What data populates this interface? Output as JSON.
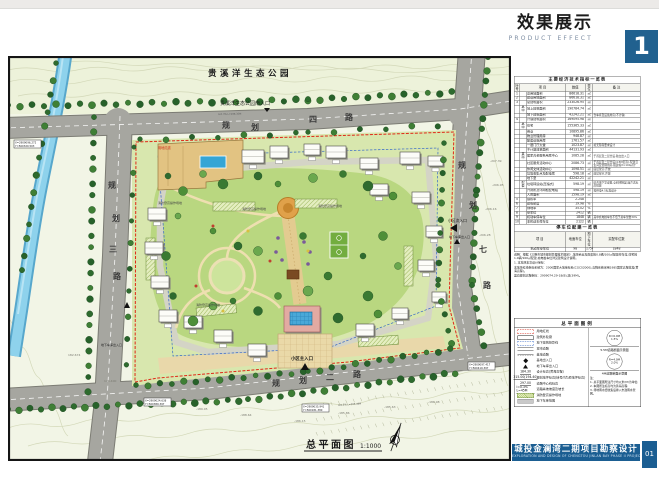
{
  "header": {
    "title_cn": "效果展示",
    "title_en": "PRODUCT  EFFECT",
    "page_num": "1"
  },
  "plan": {
    "park_label": "贵溪洋生态公园",
    "park_entrance_label": "贵溪洋生态公园南入口",
    "roads": {
      "top": "规划四路",
      "left": "规划三路",
      "right": "规划七路",
      "bottom": "规划二路"
    },
    "entrances": {
      "main": "小区主入口",
      "secondary": "小区次入口",
      "garage": "地下车库出入口"
    },
    "boundary_label": "用地红线",
    "fire_lane_label": "消防登高操作场地",
    "scale_label": "总平面图",
    "scale_value": "1:1000",
    "road_notes": [
      "i=0.5% L=205.49M",
      "i=0.3% L=198.35M"
    ],
    "spot_elevations": [
      "-207.39",
      "-206.95",
      "-206.16",
      "-206.28",
      "-189.05",
      "-188.64",
      "-186.15",
      "-185.86",
      "-185.63",
      "-186.98",
      "182.674",
      "176.400"
    ],
    "coord_markers": [
      {
        "x_val": "X=2909096.272",
        "y_val": "Y=560320.503"
      },
      {
        "x_val": "X=2909024.638",
        "y_val": "Y=560389.397"
      },
      {
        "x_val": "X=2909035.941",
        "y_val": "Y=560181.380"
      },
      {
        "x_val": "X=2909097.417",
        "y_val": "Y=560419.397"
      }
    ]
  },
  "table": {
    "title": "主要经济技术指标一览表",
    "headers": [
      "序号",
      "项  目",
      "数值",
      "单位",
      "备  注"
    ],
    "rows": [
      [
        "1",
        "",
        "总用地面积",
        "86618.31",
        "㎡",
        ""
      ],
      [
        "2",
        "",
        "建设用地面积",
        "86618.31",
        "㎡",
        ""
      ],
      [
        "3",
        "",
        "总建筑面积",
        "233026.95",
        "㎡",
        ""
      ],
      [
        "",
        "其中",
        "地上建筑面积",
        "190784.74",
        "㎡",
        ""
      ],
      [
        "",
        "",
        "地下建筑面积",
        "42242.21",
        "㎡",
        "含车库及设备用房(不计容)"
      ],
      [
        "4",
        "",
        "计容建筑面积",
        "169095.98",
        "㎡",
        ""
      ],
      [
        "",
        "其中",
        "住宅",
        "155365.33",
        "㎡",
        ""
      ],
      [
        "",
        "",
        "商业",
        "10895.86",
        "㎡",
        ""
      ],
      [
        "",
        "",
        "物业管理用房",
        "948.87",
        "㎡",
        ""
      ],
      [
        "",
        "",
        "配套设施用房",
        "1761.57",
        "㎡",
        ""
      ],
      [
        "",
        "",
        "一层门厅大堂",
        "1023.87",
        "㎡",
        "按无障碍要求设计"
      ],
      [
        "",
        "",
        "不计容建筑面积",
        "44131.93",
        "㎡",
        ""
      ],
      [
        "",
        "其中",
        "居家养老服务用房中心",
        "1085.28",
        "㎡",
        "于首层及二层合设,独立出入口"
      ],
      [
        "",
        "",
        "社区服务活动中心",
        "2086.73",
        "㎡",
        "于首层及二层合设(4.5M层高),配建卫生间及管理用房,报建按2×100㎡计"
      ],
      [
        "",
        "",
        "休闲文体活动中心",
        "1098.51",
        "㎡",
        "底层架空,开放"
      ],
      [
        "",
        "",
        "垃圾收集点及配电房",
        "598.18",
        "㎡",
        "底层架空,开放"
      ],
      [
        "",
        "",
        "地下室",
        "42242.21",
        "㎡",
        ""
      ],
      [
        "",
        "配套",
        "垃圾转运站(压缩式)",
        "598.19",
        "㎡",
        "结合地下室设置,全封闭除臭,噪声达标后排放"
      ],
      [
        "",
        "",
        "开闭所及环网柜配电站",
        "598.19",
        "㎡",
        "按供电4.5标准设计"
      ],
      [
        "",
        "",
        "人防面积",
        "1598.19",
        "㎡",
        ""
      ],
      [
        "5",
        "",
        "容积率",
        "2.248",
        "",
        ""
      ],
      [
        "6",
        "",
        "建筑密度",
        "19.98",
        "%",
        ""
      ],
      [
        "7",
        "",
        "绿地率",
        "35.02",
        "%",
        ""
      ],
      [
        "8",
        "",
        "停车位",
        "2412",
        "辆",
        ""
      ],
      [
        "9",
        "",
        "机动车停车位",
        "1848",
        "辆",
        "其中充电桩车位不低于总车位数30%"
      ],
      [
        "10",
        "",
        "非机动车停车位",
        "2122",
        "辆",
        ""
      ]
    ],
    "sub_title": "停车位配建一览表",
    "sub_headers": [
      "项  目",
      "地面车位",
      "地下车位",
      "实配车位数"
    ],
    "sub_rows": [
      [
        "机动车停车位",
        "98",
        "1750",
        "1848"
      ]
    ],
    "notes": [
      "说明：根据《三明市城市规划管理技术规定》,地块商业及配套按0.8辆/100㎡配建停车位,住宅按1.0辆/100㎡配建,充电桩车位详见建筑设计说明。",
      "1. 本地块本次设计坐标：",
      "本地块红线坐标系统为：2000国家大地坐标系(CGCS2000),高程系统采用1985国家高程基准(黄海高程)。",
      "竖向规划高程坐标：2909074.29-18(B),双(39M)。"
    ]
  },
  "legend": {
    "title": "总平面图例",
    "items": [
      {
        "sym": "redline",
        "value": "",
        "label": "用地红线"
      },
      {
        "sym": "outline",
        "value": "",
        "label": "建筑外轮廓"
      },
      {
        "sym": "ugline",
        "value": "",
        "label": "地下建筑投影线"
      },
      {
        "sym": "cityroad",
        "value": "",
        "label": "城市道路"
      },
      {
        "sym": "siteroad",
        "value": "",
        "label": "基地道路"
      },
      {
        "sym": "entry",
        "value": "",
        "label": "基地出入口"
      },
      {
        "sym": "garage",
        "value": "",
        "label": "地下车库出入口"
      },
      {
        "sym": "num",
        "value": "184.30",
        "label": "设计标高(黄海高程)"
      },
      {
        "sym": "num",
        "value": "215.00(194.40)",
        "label": "规划地坪标高(括号内为原地坪标高)"
      },
      {
        "sym": "num",
        "value": "297.00",
        "label": "道路中心线标高"
      },
      {
        "sym": "num",
        "value": "i=0.3% L=45M",
        "label": "道路纵坡坡度及坡长"
      },
      {
        "sym": "firelane",
        "value": "",
        "label": "消防登高操作场地"
      },
      {
        "sym": "uga",
        "value": "",
        "label": "地下车库范围"
      }
    ],
    "diagrams": [
      {
        "r_label": "R=6.0M",
        "slope": "1.5%",
        "caption": "5.5M道路断面示意图"
      },
      {
        "r_label": "R=4.0M",
        "slope": "2.0%",
        "caption": "4M道路断面示意图"
      }
    ],
    "notes": [
      "注：",
      "1. 总平面图所注尺寸均以米(M)为单位;",
      "2. 本图所注标高均为黄海高程;",
      "3. 场地雨水经收集后排入市政雨水管网。"
    ]
  },
  "footer": {
    "project_cn": "城投金澜湾二期项目勘察设计",
    "project_en": "EXPLORATION AND DESIGN OF CHENGTOU JINLAN BAY PHASE II PROJECT",
    "sheet_no": "01"
  }
}
